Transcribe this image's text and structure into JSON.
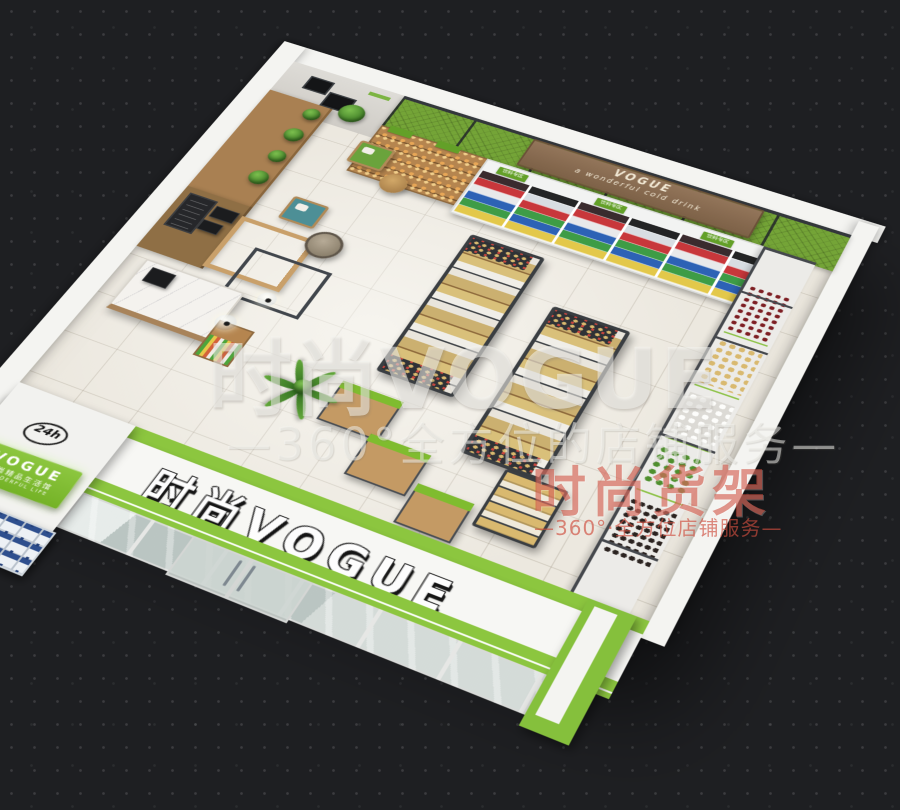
{
  "scene": {
    "description": "3D bird's-eye rendering of a VOGUE convenience store interior",
    "store_name": "时尚VOGUE"
  },
  "watermarks": {
    "main_title": "时尚VOGUE",
    "main_subtitle": "—360°全方位的店铺服务—",
    "red_title": "时尚货架",
    "red_subtitle": "—360°·全方位店铺服务—"
  },
  "storefront": {
    "fascia_sign": "时尚VOGUE",
    "badge_24h": "24h",
    "side_sign": {
      "line1": "VOGUE",
      "line2": "时尚精品生活馆",
      "line3": "WONDERFUL LIFE"
    }
  },
  "back_wall": {
    "banner_brand": "VOGUE",
    "banner_tagline": "a wonderful cold drink",
    "cooler_label": "饮料专区"
  },
  "colors": {
    "brand_green": "#8CC63F",
    "mesh_green": "#74A437",
    "steel_gray": "#42464B",
    "wood": "#B5854F",
    "floor_tile": "#ECE8DF",
    "exterior_ground": "#1F2022",
    "banner_brown": "#8A6C4E",
    "watermark_red": "#C94A3C"
  }
}
